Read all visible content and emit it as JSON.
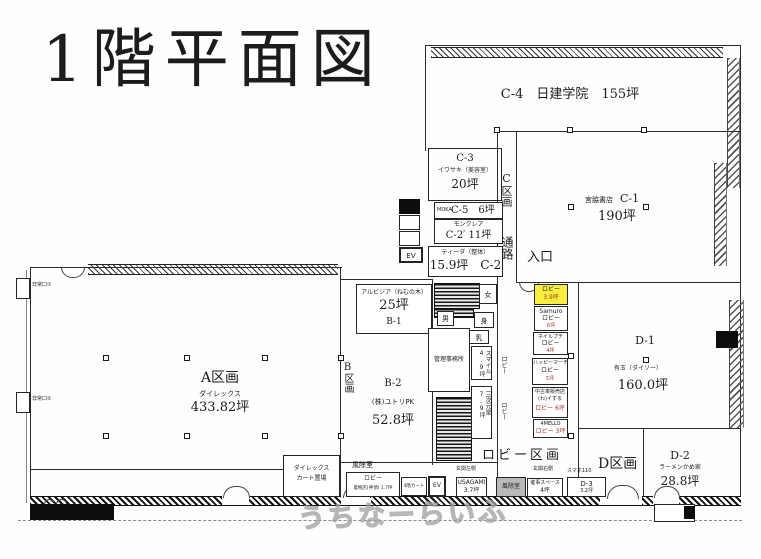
{
  "title": "1階平面図",
  "watermark": "うちなーらいふ",
  "colors": {
    "highlight": "#f9ee3f",
    "area_red": "#a23421"
  },
  "labels": {
    "c_section": "C区画",
    "corridor": "通路",
    "entrance": "入口",
    "b_section": "B区画",
    "d_section": "D区画",
    "lobby_section": "ロビー区画",
    "lobby_v": "ロビー",
    "genkan_left": "玄関左側",
    "genkan_right": "玄関右側",
    "wc_women": "女",
    "wc_men": "男",
    "wc_access": "身",
    "nursing": "乳",
    "exit1": "非常口①",
    "exit2": "非常口②",
    "ev": "EV",
    "fujo": "風除室",
    "smaho": "スマホ110"
  },
  "rooms": {
    "c4": {
      "label": "C-4　日建学院　155坪"
    },
    "c3": {
      "code": "C-3",
      "tenant": "イワサキ（美容室）",
      "area": "20坪"
    },
    "c5": {
      "brand": "MOKA",
      "label": "C-5　6坪"
    },
    "c2p": {
      "tenant": "モンクレア",
      "label": "C-2′ 11坪"
    },
    "c2": {
      "tenant": "ティーダ（整体）",
      "label": "15.9坪　C-2"
    },
    "c1": {
      "tenant": "宮脇書店",
      "code": "C-1",
      "area": "190坪"
    },
    "a": {
      "code": "A区画",
      "tenant": "ダイレックス",
      "area": "433.82坪"
    },
    "b1": {
      "tenant": "アルビジア（ねむの木）",
      "area": "25坪",
      "code": "B-1"
    },
    "b2": {
      "code": "B-2",
      "tenant": "(株)ユトリPK",
      "area": "52.8坪"
    },
    "kanri": {
      "label": "管理事務所"
    },
    "smile": {
      "label": "スマイル 4.9坪"
    },
    "sanjigen": {
      "label": "三次元堂 7.9坪"
    },
    "d1": {
      "code": "D-1",
      "tenant": "有玉（ダイソー）",
      "area": "160.0坪"
    },
    "d2": {
      "code": "D-2",
      "tenant": "ラーメンかめ家",
      "area": "28.8坪"
    },
    "d3": {
      "code": "D-3",
      "area": "3.2坪"
    },
    "usagami": {
      "tenant": "USAGAMI",
      "area": "3.7坪"
    },
    "saiji": {
      "tenant": "催事スペース",
      "area": "4坪"
    },
    "cart": {
      "line1": "ダイレックス",
      "line2": "カート置場"
    },
    "lobby_koya": {
      "label": "ロビー",
      "sub": "着物店(神領) 1.7坪"
    },
    "cart4f": {
      "label": "4階カート"
    }
  },
  "lobby_stack": [
    {
      "tenant": "ロビー",
      "area": "3.9坪",
      "highlight": true
    },
    {
      "tenant": "Samuro",
      "mid": "ロビー",
      "area": "6坪"
    },
    {
      "tenant": "ネイルプチ",
      "mid": "ロビー",
      "area": "4坪"
    },
    {
      "tenant": "ハッピーマーチ",
      "mid": "ロビー",
      "area": "5坪"
    },
    {
      "tenant": "中古車販売店",
      "sub": "(わ)イずる",
      "mid": "ロビー 6坪"
    },
    {
      "tenant": "4MELLO",
      "mid": "ロビー 3坪"
    }
  ]
}
